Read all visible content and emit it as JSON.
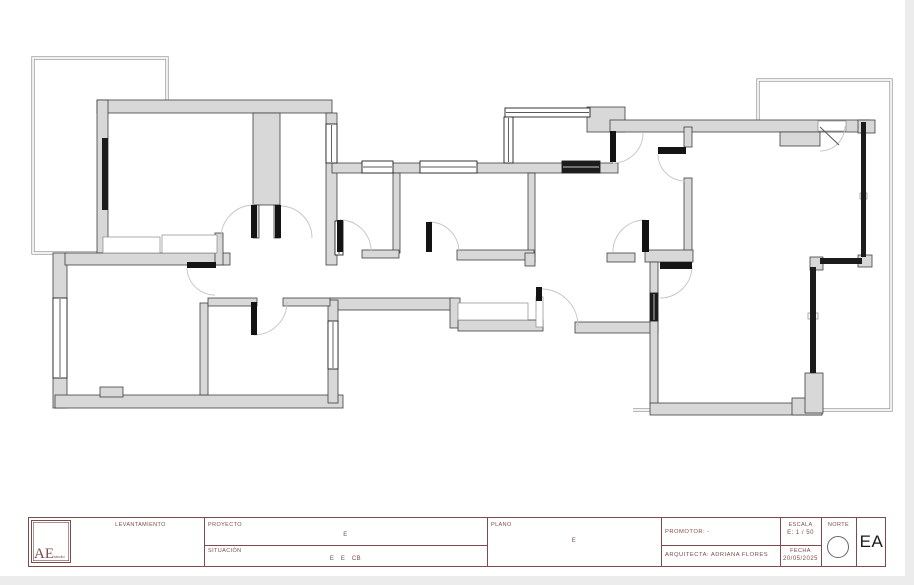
{
  "title_block": {
    "accent": "#7d4b4b",
    "logo_main": "AE",
    "logo_sub": "studio",
    "levantamiento": "LEVANTAMIENTO",
    "proyecto_label": "PROYECTO",
    "proyecto_value": "E",
    "situacion_label": "SITUACIÓN",
    "situacion_value": "E   E   CB",
    "plano_label": "PLANO",
    "plano_value": "E",
    "promotor": "PROMOTOR: -",
    "arquitecta": "ARQUITECTA: ADRIANA FLORES",
    "escala_label": "ESCALA",
    "escala_value": "E: 1 / 50",
    "fecha_label": "FECHA",
    "fecha_value": "20/05/2025",
    "norte": "NORTE",
    "sheet_code": "EA"
  },
  "plan": {
    "wall_fill": "#d8d8d8",
    "wall_stroke": "#3f3f3f",
    "terrace_stroke": "#8f8f8f",
    "arc_stroke": "#c4c4c4",
    "leaf_fill": "#141414",
    "glazing_fill": "#1c1c1c",
    "edge_strip_fill": "#ececec",
    "edge_strips": [
      [
        0,
        576,
        914,
        9
      ],
      [
        905,
        0,
        9,
        585
      ]
    ],
    "terraces": [
      "M167,100 L167,58 L33,58 L33,253 L97,253",
      "M758,120 L758,80 L891,80 L891,410 L633,410"
    ],
    "walls": [
      [
        97,
        100,
        235,
        13
      ],
      [
        97,
        100,
        11,
        153
      ],
      [
        253,
        113,
        27,
        92
      ],
      [
        253,
        205,
        6,
        33
      ],
      [
        274,
        205,
        6,
        33
      ],
      [
        326,
        113,
        11,
        152
      ],
      [
        332,
        163,
        286,
        10
      ],
      [
        393,
        173,
        7,
        80
      ],
      [
        528,
        173,
        7,
        89
      ],
      [
        362,
        250,
        37,
        8
      ],
      [
        457,
        250,
        77,
        10
      ],
      [
        607,
        253,
        28,
        9
      ],
      [
        525,
        253,
        10,
        13
      ],
      [
        587,
        107,
        38,
        25
      ],
      [
        610,
        120,
        260,
        12
      ],
      [
        780,
        132,
        40,
        14
      ],
      [
        858,
        120,
        17,
        13
      ],
      [
        684,
        127,
        8,
        20
      ],
      [
        684,
        178,
        8,
        74
      ],
      [
        645,
        250,
        48,
        12
      ],
      [
        330,
        298,
        123,
        12
      ],
      [
        450,
        298,
        10,
        30
      ],
      [
        458,
        320,
        85,
        11
      ],
      [
        575,
        322,
        83,
        11
      ],
      [
        53,
        253,
        14,
        155
      ],
      [
        65,
        253,
        165,
        12
      ],
      [
        215,
        233,
        8,
        32
      ],
      [
        55,
        395,
        288,
        13
      ],
      [
        100,
        387,
        23,
        10
      ],
      [
        328,
        300,
        10,
        103
      ],
      [
        200,
        303,
        8,
        92
      ],
      [
        208,
        298,
        49,
        8
      ],
      [
        283,
        298,
        47,
        8
      ],
      [
        650,
        262,
        8,
        33
      ],
      [
        650,
        320,
        8,
        85
      ],
      [
        650,
        403,
        172,
        12
      ],
      [
        792,
        398,
        30,
        17
      ],
      [
        805,
        373,
        18,
        40
      ],
      [
        810,
        257,
        13,
        13
      ],
      [
        858,
        255,
        14,
        12
      ]
    ],
    "white_insets": [
      [
        103,
        237,
        57,
        16
      ],
      [
        162,
        235,
        55,
        18
      ],
      [
        458,
        303,
        70,
        17
      ],
      [
        536,
        297,
        7,
        30
      ],
      [
        818,
        121,
        28,
        10
      ],
      [
        860,
        193,
        7,
        6
      ],
      [
        808,
        313,
        10,
        6
      ]
    ],
    "glazing": [
      [
        861,
        122,
        5,
        135
      ],
      [
        820,
        258,
        42,
        6
      ],
      [
        810,
        267,
        6,
        106
      ],
      [
        102,
        138,
        6,
        72
      ]
    ],
    "windows": [
      {
        "x": 362,
        "y": 161,
        "w": 31,
        "h": 12,
        "type": "frame"
      },
      {
        "x": 420,
        "y": 161,
        "w": 57,
        "h": 12,
        "type": "frame"
      },
      {
        "x": 562,
        "y": 161,
        "w": 38,
        "h": 12,
        "type": "dark"
      },
      {
        "x": 53,
        "y": 298,
        "w": 14,
        "h": 80,
        "type": "frame"
      },
      {
        "x": 328,
        "y": 321,
        "w": 10,
        "h": 48,
        "type": "frame"
      },
      {
        "x": 326,
        "y": 124,
        "w": 11,
        "h": 39,
        "type": "frame"
      },
      {
        "x": 335,
        "y": 221,
        "w": 8,
        "h": 34,
        "type": "frame"
      },
      {
        "x": 650,
        "y": 293,
        "w": 8,
        "h": 28,
        "type": "dark"
      },
      {
        "x": 505,
        "y": 108,
        "w": 85,
        "h": 9,
        "type": "frame"
      },
      {
        "x": 504,
        "y": 117,
        "w": 9,
        "h": 46,
        "type": "frame"
      }
    ],
    "door_leaves": [
      [
        251,
        205,
        6,
        33
      ],
      [
        275,
        205,
        6,
        33
      ],
      [
        187,
        262,
        29,
        6
      ],
      [
        337,
        220,
        6,
        32
      ],
      [
        426,
        222,
        6,
        30
      ],
      [
        610,
        131,
        6,
        31
      ],
      [
        658,
        147,
        28,
        7
      ],
      [
        642,
        220,
        7,
        32
      ],
      [
        660,
        262,
        32,
        7
      ],
      [
        536,
        287,
        6,
        14
      ],
      [
        251,
        302,
        6,
        33
      ]
    ],
    "door_arcs": [
      "M254,205 A33,33 0 0 0 221,238",
      "M280,206 A32,32 0 0 1 312,238",
      "M187,268 A28,28 0 0 0 215,295",
      "M340,220 A31,31 0 0 1 371,251",
      "M429,222 A30,30 0 0 1 459,252",
      "M643,133 A30,30 0 0 1 613,163",
      "M658,154 A27,27 0 0 0 685,181",
      "M645,220 A32,32 0 0 0 613,252",
      "M692,266 A32,32 0 0 1 660,298",
      "M542,289 A37,37 0 0 1 578,326",
      "M254,335 A33,33 0 0 0 287,302",
      "M845,126 A25,25 0 0 1 820,151"
    ],
    "door_lines": [
      {
        "x1": 820,
        "y1": 127,
        "x2": 839,
        "y2": 145
      }
    ]
  }
}
